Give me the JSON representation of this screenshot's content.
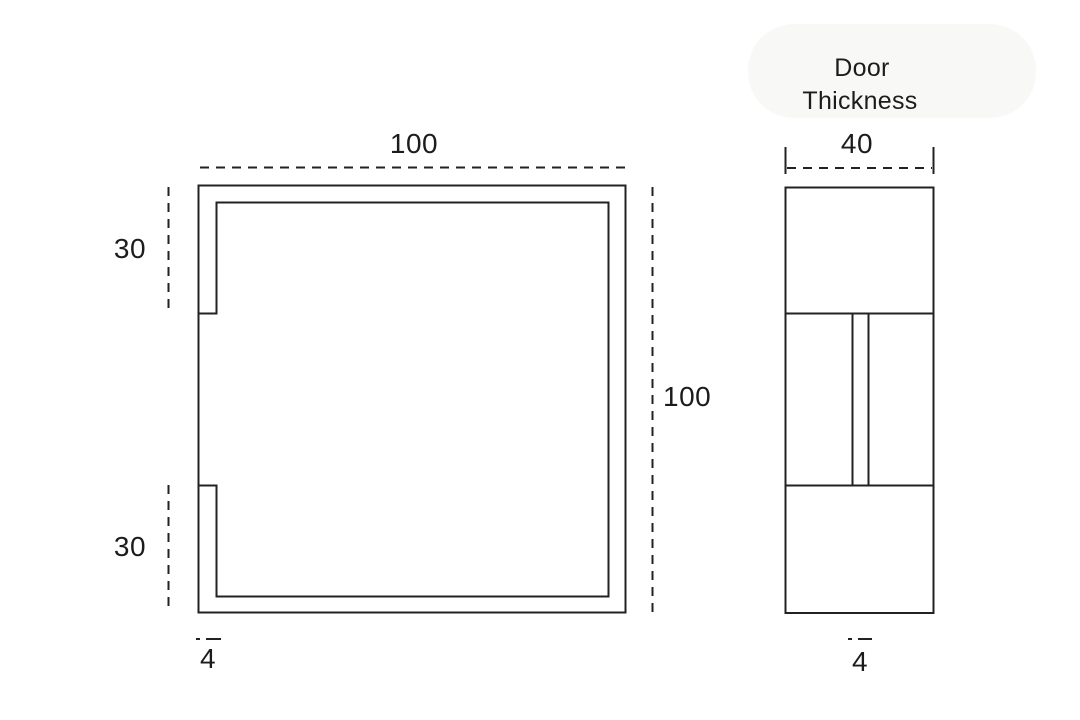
{
  "front_view": {
    "width_label": "100",
    "height_label": "100",
    "top_offset_label": "30",
    "bottom_offset_label": "30",
    "wall_thickness_label": "4"
  },
  "side_view": {
    "caption_line1": "Door",
    "caption_line2": "Thickness",
    "width_label": "40",
    "slot_width_label": "4"
  },
  "colors": {
    "line": "#222222",
    "text": "#1c1c1c",
    "background": "#ffffff",
    "highlight_blob": "#f8f8f6"
  }
}
